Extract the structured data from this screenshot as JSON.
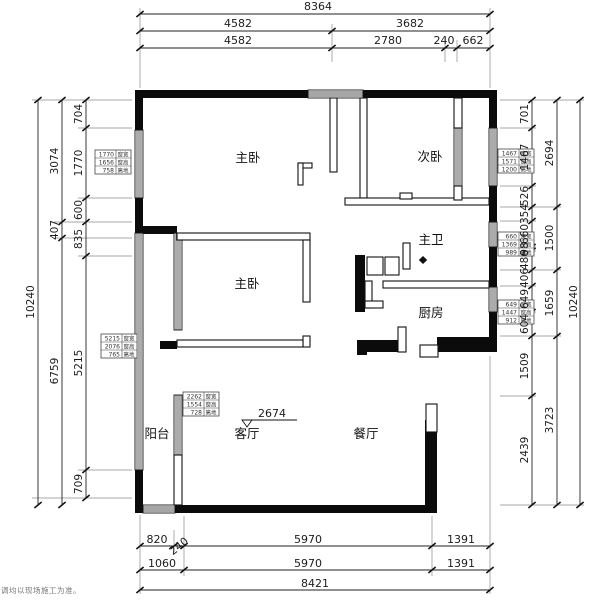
{
  "watermark": "调均以现场施工为准。",
  "rooms": [
    {
      "label": "主卧",
      "x": 248,
      "y": 162
    },
    {
      "label": "次卧",
      "x": 430,
      "y": 161
    },
    {
      "label": "主卫",
      "x": 431,
      "y": 244
    },
    {
      "label": "厨房",
      "x": 431,
      "y": 317
    },
    {
      "label": "主卧",
      "x": 247,
      "y": 288
    },
    {
      "label": "阳台",
      "x": 157,
      "y": 438
    },
    {
      "label": "客厅",
      "x": 247,
      "y": 438
    },
    {
      "label": "餐厅",
      "x": 366,
      "y": 438
    }
  ],
  "annotation": {
    "text": "2674"
  },
  "dimensions": {
    "top": [
      {
        "t": "8364",
        "x": 318,
        "y": 10
      },
      {
        "t": "4582",
        "x": 238,
        "y": 27
      },
      {
        "t": "3682",
        "x": 410,
        "y": 27
      },
      {
        "t": "4582",
        "x": 238,
        "y": 44
      },
      {
        "t": "2780",
        "x": 388,
        "y": 44
      },
      {
        "t": "240",
        "x": 444,
        "y": 44
      },
      {
        "t": "662",
        "x": 473,
        "y": 44
      }
    ],
    "bottom": [
      {
        "t": "820",
        "x": 157,
        "y": 543
      },
      {
        "t": "240",
        "x": 181,
        "y": 549,
        "r": -38
      },
      {
        "t": "5970",
        "x": 308,
        "y": 543
      },
      {
        "t": "1391",
        "x": 461,
        "y": 543
      },
      {
        "t": "1060",
        "x": 162,
        "y": 567
      },
      {
        "t": "5970",
        "x": 308,
        "y": 567
      },
      {
        "t": "1391",
        "x": 461,
        "y": 567
      },
      {
        "t": "8421",
        "x": 315,
        "y": 587
      }
    ],
    "left": [
      {
        "t": "10240",
        "x": 34,
        "y": 302,
        "r": -90
      },
      {
        "t": "3074",
        "x": 58,
        "y": 161,
        "r": -90
      },
      {
        "t": "407",
        "x": 58,
        "y": 230,
        "r": -90
      },
      {
        "t": "6759",
        "x": 58,
        "y": 371,
        "r": -90
      },
      {
        "t": "704",
        "x": 82,
        "y": 114,
        "r": -90
      },
      {
        "t": "1770",
        "x": 82,
        "y": 163,
        "r": -90
      },
      {
        "t": "600",
        "x": 82,
        "y": 210,
        "r": -90
      },
      {
        "t": "835",
        "x": 82,
        "y": 239,
        "r": -90
      },
      {
        "t": "5215",
        "x": 82,
        "y": 363,
        "r": -90
      },
      {
        "t": "709",
        "x": 82,
        "y": 484,
        "r": -90
      }
    ],
    "right": [
      {
        "t": "701",
        "x": 528,
        "y": 114,
        "r": -90
      },
      {
        "t": "1467",
        "x": 528,
        "y": 157,
        "r": -90
      },
      {
        "t": "526",
        "x": 528,
        "y": 196,
        "r": -90
      },
      {
        "t": "354",
        "x": 528,
        "y": 214,
        "r": -90
      },
      {
        "t": "660",
        "x": 528,
        "y": 234,
        "r": -90
      },
      {
        "t": "98",
        "x": 528,
        "y": 249,
        "r": -90
      },
      {
        "t": "486",
        "x": 528,
        "y": 260,
        "r": -90
      },
      {
        "t": "406",
        "x": 528,
        "y": 278,
        "r": -90
      },
      {
        "t": "649",
        "x": 528,
        "y": 299,
        "r": -90
      },
      {
        "t": "604",
        "x": 528,
        "y": 324,
        "r": -90
      },
      {
        "t": "1509",
        "x": 528,
        "y": 366,
        "r": -90
      },
      {
        "t": "2439",
        "x": 528,
        "y": 450,
        "r": -90
      },
      {
        "t": "2694",
        "x": 553,
        "y": 153,
        "r": -90
      },
      {
        "t": "1500",
        "x": 553,
        "y": 238,
        "r": -90
      },
      {
        "t": "1659",
        "x": 553,
        "y": 303,
        "r": -90
      },
      {
        "t": "3723",
        "x": 553,
        "y": 420,
        "r": -90
      },
      {
        "t": "10240",
        "x": 577,
        "y": 302,
        "r": -90
      }
    ]
  },
  "window_tables": [
    {
      "x": 95,
      "y": 150,
      "rows": [
        [
          "1770",
          "窗宽"
        ],
        [
          "1656",
          "窗高"
        ],
        [
          "758",
          "离地"
        ]
      ]
    },
    {
      "x": 101,
      "y": 334,
      "rows": [
        [
          "5215",
          "窗宽"
        ],
        [
          "2076",
          "窗高"
        ],
        [
          "765",
          "离地"
        ]
      ]
    },
    {
      "x": 498,
      "y": 149,
      "rows": [
        [
          "1467",
          "窗宽"
        ],
        [
          "1571",
          "窗高"
        ],
        [
          "1200",
          "离地"
        ]
      ]
    },
    {
      "x": 498,
      "y": 232,
      "rows": [
        [
          "660",
          "窗宽"
        ],
        [
          "1369",
          "窗高"
        ],
        [
          "989",
          "离地"
        ]
      ]
    },
    {
      "x": 498,
      "y": 300,
      "rows": [
        [
          "649",
          "窗宽"
        ],
        [
          "1447",
          "窗高"
        ],
        [
          "912",
          "离地"
        ]
      ]
    },
    {
      "x": 183,
      "y": 392,
      "rows": [
        [
          "2262",
          "窗宽"
        ],
        [
          "1554",
          "窗高"
        ],
        [
          "728",
          "离地"
        ]
      ]
    }
  ]
}
